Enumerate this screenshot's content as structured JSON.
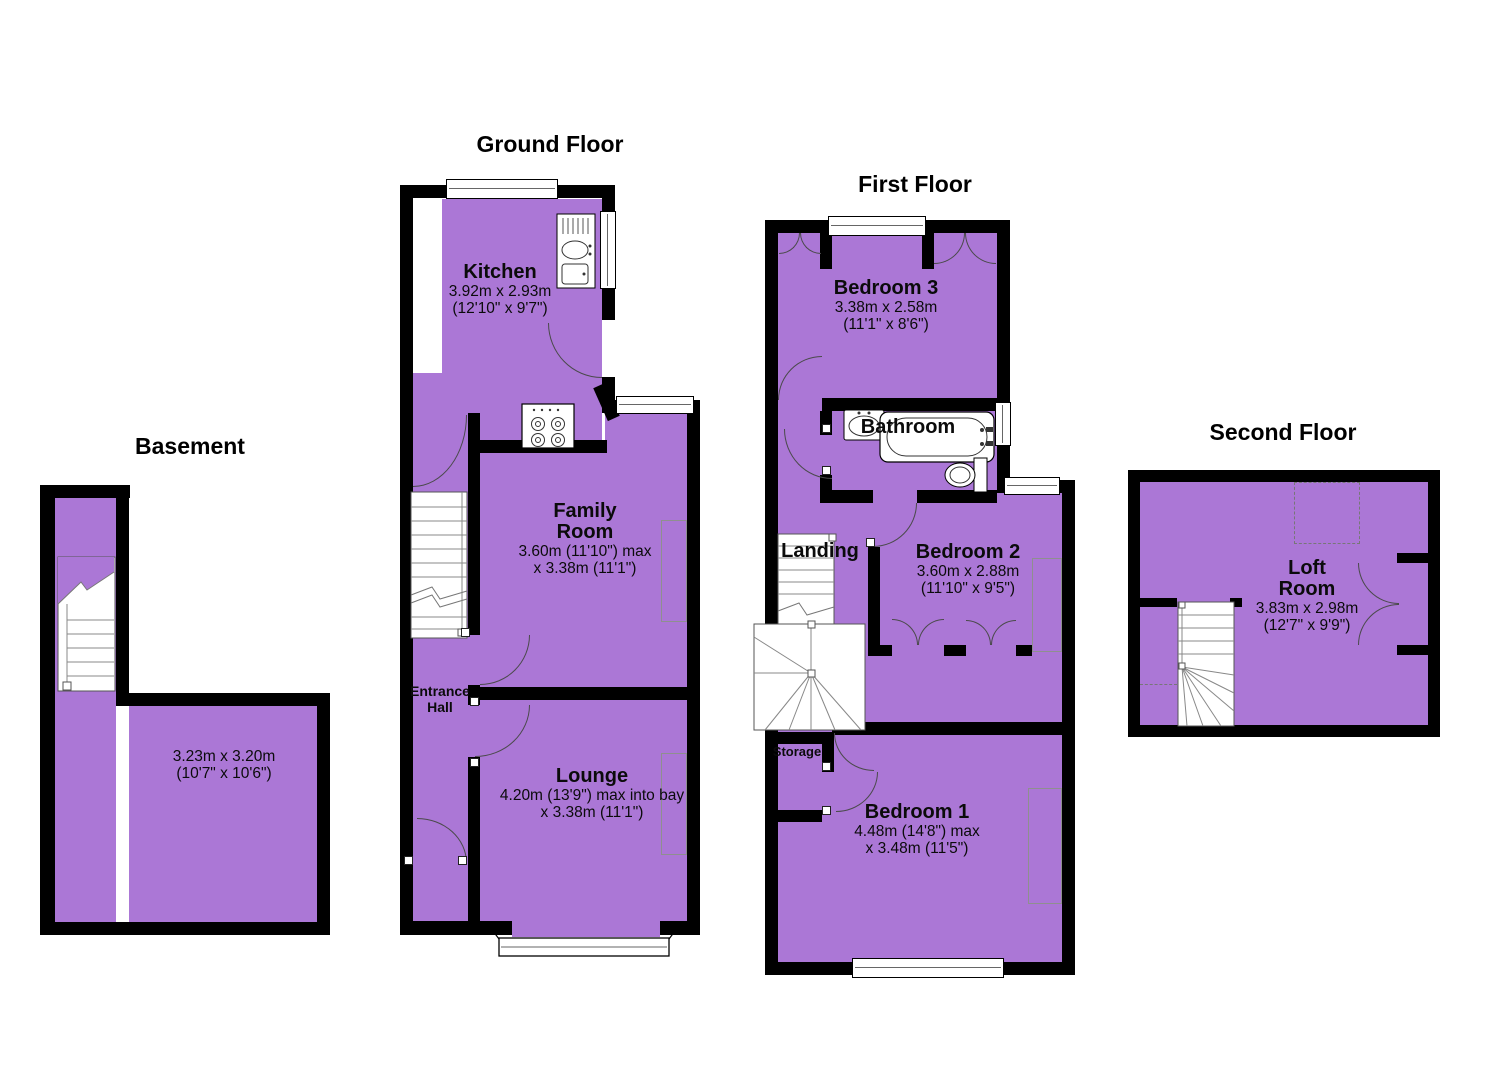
{
  "colors": {
    "room_fill": "#ab77d6",
    "wall": "#000000",
    "stair_line": "#808080"
  },
  "floors": {
    "basement": {
      "title": "Basement",
      "room": {
        "dim1": "3.23m x 3.20m",
        "dim2": "(10'7\" x 10'6\")"
      }
    },
    "ground": {
      "title": "Ground Floor",
      "rooms": {
        "kitchen": {
          "name": "Kitchen",
          "dim1": "3.92m x 2.93m",
          "dim2": "(12'10\" x 9'7\")"
        },
        "family": {
          "name1": "Family",
          "name2": "Room",
          "dim1": "3.60m (11'10\") max",
          "dim2": "x 3.38m (11'1\")"
        },
        "entrance": {
          "name1": "Entrance",
          "name2": "Hall"
        },
        "lounge": {
          "name": "Lounge",
          "dim1": "4.20m (13'9\") max into bay",
          "dim2": "x 3.38m (11'1\")"
        }
      }
    },
    "first": {
      "title": "First Floor",
      "rooms": {
        "bedroom3": {
          "name": "Bedroom 3",
          "dim1": "3.38m x 2.58m",
          "dim2": "(11'1\" x 8'6\")"
        },
        "bathroom": {
          "name": "Bathroom"
        },
        "landing": {
          "name": "Landing"
        },
        "bedroom2": {
          "name": "Bedroom 2",
          "dim1": "3.60m x 2.88m",
          "dim2": "(11'10\" x 9'5\")"
        },
        "storage": {
          "name": "Storage"
        },
        "bedroom1": {
          "name": "Bedroom 1",
          "dim1": "4.48m (14'8\") max",
          "dim2": "x 3.48m (11'5\")"
        }
      }
    },
    "second": {
      "title": "Second Floor",
      "rooms": {
        "loft": {
          "name1": "Loft",
          "name2": "Room",
          "dim1": "3.83m x 2.98m",
          "dim2": "(12'7\" x 9'9\")"
        }
      }
    }
  },
  "icons": {
    "staircase": "stepped-lines",
    "winder-stairs": "fan-lines",
    "bath": "rounded-rect",
    "toilet": "ellipse-with-tank",
    "wash-basin": "oval-in-rect",
    "kitchen-sink": "drainer-oval-basin",
    "hob": "four-burner-circles",
    "window": "double-line-rect",
    "bay-window": "angled-window-band",
    "door": "quarter-arc",
    "wardrobe": "double-quarter-arcs",
    "skylight": "dashed-rect"
  }
}
